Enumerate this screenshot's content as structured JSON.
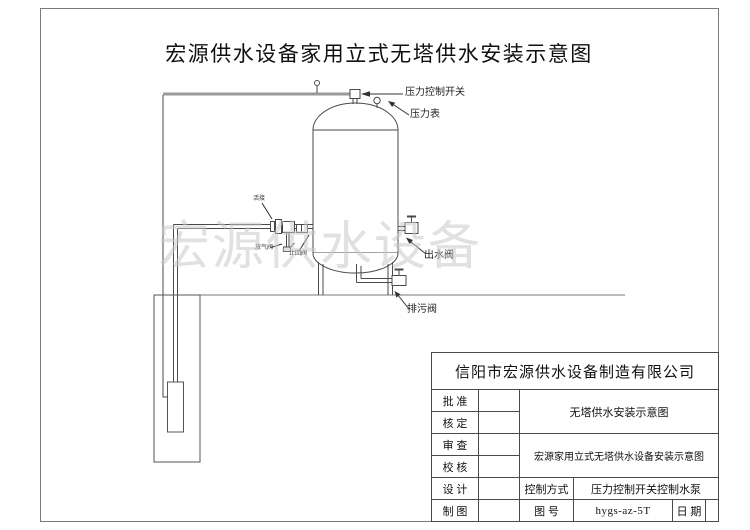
{
  "page": {
    "title": "宏源供水设备家用立式无塔供水安装示意图",
    "watermark": "宏源供水设备"
  },
  "labels": {
    "pressure_switch": "压力控制开关",
    "pressure_gauge": "压力表",
    "outlet_valve": "出水阀",
    "drain_valve": "排污阀",
    "union": "活接",
    "air_release_valve": "放气阀",
    "check_valve": "止回阀"
  },
  "title_block": {
    "company": "信阳市宏源供水设备制造有限公司",
    "row_labels": [
      "批 准",
      "核 定",
      "审 查",
      "校 核",
      "设 计",
      "制 图"
    ],
    "doc_title_short": "无塔供水安装示意图",
    "doc_title_full": "宏源家用立式无塔供水设备安装示意图",
    "control_mode_label": "控制方式",
    "control_mode_value": "压力控制开关控制水泵",
    "drawing_no_label": "图 号",
    "drawing_no_value": "hygs-az-5T",
    "date_label": "日 期"
  },
  "colors": {
    "line": "#4a4a4a",
    "pipe_gray": "#9a9a9a",
    "watermark_gray": "#c9c9c9"
  }
}
